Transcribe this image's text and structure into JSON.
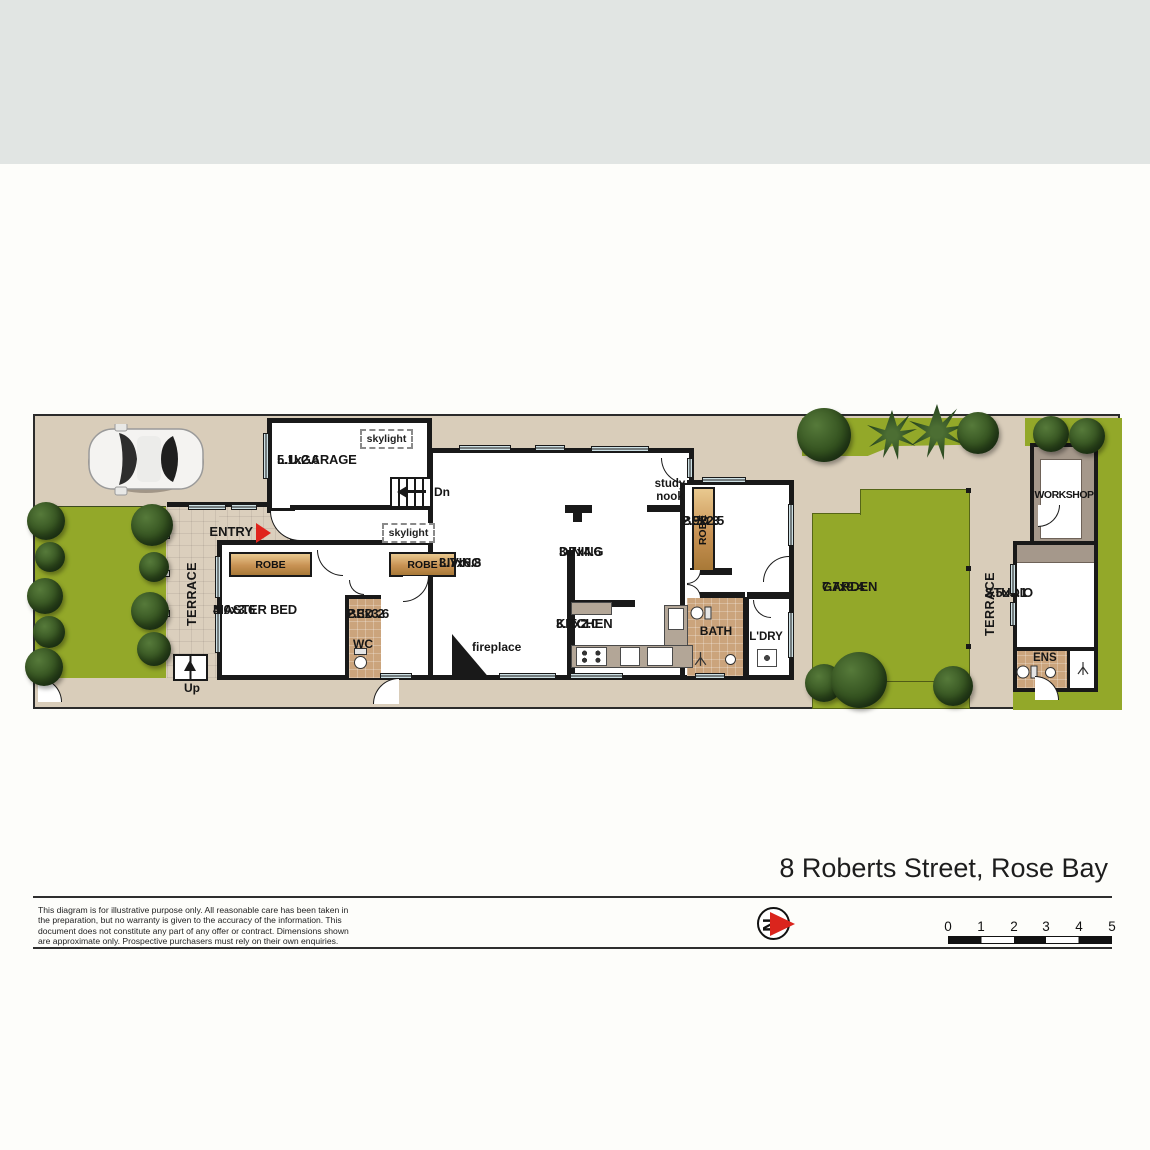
{
  "footer": {
    "address": "8 Roberts Street, Rose Bay",
    "disclaimer_lines": [
      "This diagram is for illustrative purpose only. All reasonable care has been taken in",
      "the preparation, but no warranty is given to the accuracy of the information. This",
      "document does not constitute any part of any offer or contract. Dimensions shown",
      "are approximate only. Prospective purchasers must rely on their own enquiries."
    ],
    "compass_letter": "N",
    "scale_ticks": [
      "0",
      "1",
      "2",
      "3",
      "4",
      "5"
    ]
  },
  "plan": {
    "rooms": {
      "garage": {
        "name": "L.U.GARAGE",
        "dims": "5.1x2.6"
      },
      "master_bed": {
        "name": "MASTER BED",
        "dims": "4.0x3.6"
      },
      "bed2": {
        "name": "BED 2",
        "dims": "2.3x3.6"
      },
      "bed3": {
        "name": "BED 3",
        "dims": "2.9x2.5"
      },
      "living": {
        "name": "LIVING",
        "dims": "3.7x6.8"
      },
      "dining": {
        "name": "DINING",
        "dims": "3.7x4.6"
      },
      "kitchen": {
        "name": "KITCHEN",
        "dims": "3.7x2.0"
      },
      "garden": {
        "name": "GARDEN",
        "dims": "7.7x9.4"
      },
      "studio": {
        "name": "STUDIO",
        "dims": "2.5x3.1"
      },
      "workshop": {
        "name": "WORKSHOP"
      }
    },
    "labels": {
      "entry": "ENTRY",
      "terrace": "TERRACE",
      "robe": "ROBE",
      "wc": "WC",
      "bath": "BATH",
      "laundry": "L'DRY",
      "ensuite": "ENS",
      "study_nook": "study nook",
      "fireplace": "fireplace",
      "skylight": "skylight",
      "stairs_down": "Dn",
      "stairs_up": "Up"
    }
  },
  "colors": {
    "band_grey": "#e1e5e3",
    "site_tan": "#d9cdba",
    "grass_green": "#93a829",
    "wall_black": "#191919",
    "robe_tan": "#c89254",
    "window_blue": "#cde0e4",
    "tile_tan": "#cba47c",
    "workshop_grey": "#a5988b",
    "accent_red": "#da251d"
  }
}
